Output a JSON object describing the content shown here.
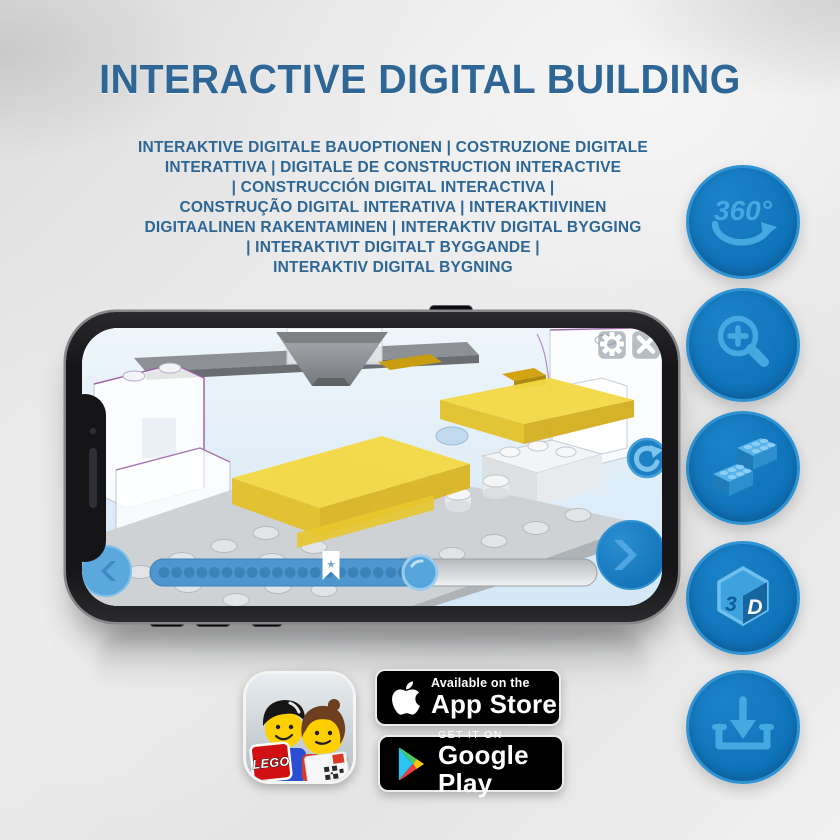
{
  "page": {
    "title": "INTERACTIVE DIGITAL BUILDING"
  },
  "subtitle": {
    "lines": [
      "INTERAKTIVE DIGITALE BAUOPTIONEN | COSTRUZIONE DIGITALE",
      "INTERATTIVA | DIGITALE DE CONSTRUCTION INTERACTIVE",
      "| CONSTRUCCIÓN DIGITAL INTERACTIVA |",
      "CONSTRUÇÃO DIGITAL INTERATIVA | INTERAKTIIVINEN",
      "DIGITAALINEN RAKENTAMINEN | INTERAKTIV DIGITAL BYGGING",
      "| INTERAKTIVT DIGITALT BYGGANDE |",
      "INTERAKTIV DIGITAL BYGNING"
    ]
  },
  "feature_buttons": [
    {
      "name": "360-view",
      "label": "360°"
    },
    {
      "name": "zoom-in"
    },
    {
      "name": "lego-bricks"
    },
    {
      "name": "3d-view",
      "char_left": "3",
      "char_right": "D"
    },
    {
      "name": "download"
    }
  ],
  "phone": {
    "screen": {
      "progress": {
        "fill_percent": 62,
        "dots_total": 20,
        "marker": "star"
      }
    }
  },
  "icons": {
    "star": "★"
  },
  "badges": {
    "app_store": {
      "top": "Available on the",
      "bottom": "App Store"
    },
    "google_play": {
      "top": "GET IT ON",
      "bottom": "Google Play"
    },
    "lego_app": {
      "logo_text": "LEGO"
    }
  },
  "colors": {
    "title_blue": "#2e6695",
    "button_blue": "#0f72b9",
    "button_rim": "#2f93d3",
    "glyph_blue": "#41a5e0",
    "screen_sky": "#ddeefa",
    "brick_yellow": "#f3d843",
    "bar_fill": "#4e96ce"
  }
}
